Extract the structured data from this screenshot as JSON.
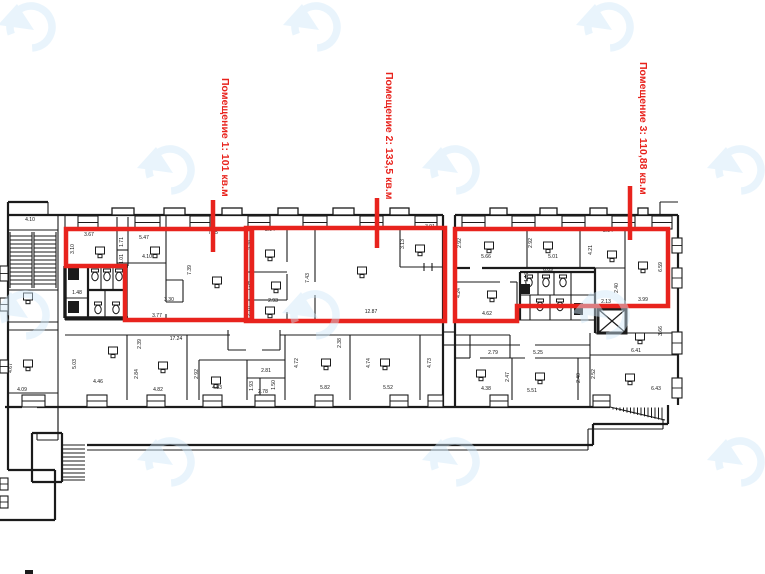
{
  "colors": {
    "annotation_red": "#e8231d",
    "wall_black": "#1b1b1b",
    "watermark_blue": "#cfe8f9"
  },
  "annotations": {
    "premises": [
      {
        "label": "Помещение 1: 101 кв.м",
        "label_x": 222,
        "label_y": 78,
        "leader": [
          213,
          200,
          213,
          252
        ],
        "outline": [
          [
            66,
            229
          ],
          [
            252,
            229
          ],
          [
            252,
            320
          ],
          [
            125,
            320
          ],
          [
            125,
            266
          ],
          [
            66,
            266
          ]
        ]
      },
      {
        "label": "Помещение 2: 133,5 кв.м",
        "label_x": 386,
        "label_y": 72,
        "leader": [
          377,
          198,
          377,
          248
        ],
        "outline": [
          [
            246,
            228
          ],
          [
            445,
            228
          ],
          [
            445,
            321
          ],
          [
            246,
            321
          ]
        ]
      },
      {
        "label": "Помещение 3: 110,88 кв.м",
        "label_x": 640,
        "label_y": 62,
        "leader": [
          630,
          186,
          630,
          240
        ],
        "outline": [
          [
            455,
            229
          ],
          [
            668,
            229
          ],
          [
            668,
            306
          ],
          [
            517,
            306
          ],
          [
            517,
            321
          ],
          [
            455,
            321
          ]
        ]
      }
    ]
  },
  "plan": {
    "dimensions": [
      {
        "v": "4.10",
        "x": 30,
        "y": 221,
        "r": 0
      },
      {
        "v": "4.67",
        "x": 12,
        "y": 368,
        "r": -90
      },
      {
        "v": "4.09",
        "x": 22,
        "y": 391,
        "r": 0
      },
      {
        "v": "3.67",
        "x": 89,
        "y": 236,
        "r": 0
      },
      {
        "v": "3.10",
        "x": 74,
        "y": 249,
        "r": -90
      },
      {
        "v": "1.71",
        "x": 123,
        "y": 242,
        "r": -90
      },
      {
        "v": "1.01",
        "x": 123,
        "y": 259,
        "r": -90
      },
      {
        "v": "5.47",
        "x": 144,
        "y": 239,
        "r": 0
      },
      {
        "v": "4.10",
        "x": 147,
        "y": 258,
        "r": 0
      },
      {
        "v": "7.45",
        "x": 213,
        "y": 234,
        "r": 0
      },
      {
        "v": "7.39",
        "x": 191,
        "y": 270,
        "r": -90
      },
      {
        "v": "3.30",
        "x": 169,
        "y": 301,
        "r": 0
      },
      {
        "v": "3.77",
        "x": 157,
        "y": 317,
        "r": 0
      },
      {
        "v": "1.48",
        "x": 77,
        "y": 294,
        "r": 0
      },
      {
        "v": "17.24",
        "x": 176,
        "y": 340,
        "r": 0
      },
      {
        "v": "2.94",
        "x": 270,
        "y": 231,
        "r": 0
      },
      {
        "v": "3.78",
        "x": 252,
        "y": 245,
        "r": -90
      },
      {
        "v": "1.34",
        "x": 250,
        "y": 286,
        "r": -90
      },
      {
        "v": "2.93",
        "x": 273,
        "y": 302,
        "r": 0
      },
      {
        "v": "2.18",
        "x": 250,
        "y": 311,
        "r": -90
      },
      {
        "v": "7.43",
        "x": 309,
        "y": 278,
        "r": -90
      },
      {
        "v": "12.87",
        "x": 371,
        "y": 313,
        "r": 0
      },
      {
        "v": "3.91",
        "x": 430,
        "y": 228,
        "r": 0
      },
      {
        "v": "3.13",
        "x": 404,
        "y": 244,
        "r": -90
      },
      {
        "v": "2.39",
        "x": 141,
        "y": 344,
        "r": -90
      },
      {
        "v": "2.38",
        "x": 341,
        "y": 343,
        "r": -90
      },
      {
        "v": "5.03",
        "x": 76,
        "y": 364,
        "r": -90
      },
      {
        "v": "4.46",
        "x": 98,
        "y": 383,
        "r": 0
      },
      {
        "v": "2.84",
        "x": 138,
        "y": 374,
        "r": -90
      },
      {
        "v": "4.82",
        "x": 158,
        "y": 391,
        "r": 0
      },
      {
        "v": "2.92",
        "x": 198,
        "y": 374,
        "r": -90
      },
      {
        "v": "4.83",
        "x": 217,
        "y": 389,
        "r": 0
      },
      {
        "v": "2.81",
        "x": 266,
        "y": 372,
        "r": 0
      },
      {
        "v": "1.93",
        "x": 253,
        "y": 386,
        "r": -90
      },
      {
        "v": "2.78",
        "x": 263,
        "y": 393,
        "r": 0
      },
      {
        "v": "1.50",
        "x": 275,
        "y": 385,
        "r": -90
      },
      {
        "v": "4.72",
        "x": 298,
        "y": 363,
        "r": -90
      },
      {
        "v": "5.82",
        "x": 325,
        "y": 389,
        "r": 0
      },
      {
        "v": "4.74",
        "x": 370,
        "y": 363,
        "r": -90
      },
      {
        "v": "5.52",
        "x": 388,
        "y": 389,
        "r": 0
      },
      {
        "v": "4.73",
        "x": 431,
        "y": 363,
        "r": -90
      },
      {
        "v": "2.92",
        "x": 461,
        "y": 243,
        "r": -90
      },
      {
        "v": "5.66",
        "x": 486,
        "y": 258,
        "r": 0
      },
      {
        "v": "2.92",
        "x": 532,
        "y": 243,
        "r": -90
      },
      {
        "v": "5.01",
        "x": 553,
        "y": 258,
        "r": 0
      },
      {
        "v": "2.54",
        "x": 608,
        "y": 232,
        "r": 0
      },
      {
        "v": "4.21",
        "x": 592,
        "y": 250,
        "r": -90
      },
      {
        "v": "6.09",
        "x": 548,
        "y": 271,
        "r": 0
      },
      {
        "v": "1.17",
        "x": 528,
        "y": 277,
        "r": -90
      },
      {
        "v": "4.24",
        "x": 460,
        "y": 293,
        "r": -90
      },
      {
        "v": "4.62",
        "x": 487,
        "y": 315,
        "r": 0
      },
      {
        "v": "6.59",
        "x": 662,
        "y": 267,
        "r": -90
      },
      {
        "v": "2.40",
        "x": 618,
        "y": 288,
        "r": -90
      },
      {
        "v": "2.13",
        "x": 606,
        "y": 303,
        "r": 0
      },
      {
        "v": "3.99",
        "x": 643,
        "y": 301,
        "r": 0
      },
      {
        "v": "3.66",
        "x": 662,
        "y": 331,
        "r": -90
      },
      {
        "v": "6.41",
        "x": 636,
        "y": 352,
        "r": 0
      },
      {
        "v": "2.79",
        "x": 493,
        "y": 354,
        "r": 0
      },
      {
        "v": "5.25",
        "x": 538,
        "y": 354,
        "r": 0
      },
      {
        "v": "4.38",
        "x": 486,
        "y": 390,
        "r": 0
      },
      {
        "v": "2.47",
        "x": 509,
        "y": 377,
        "r": -90
      },
      {
        "v": "5.51",
        "x": 532,
        "y": 392,
        "r": 0
      },
      {
        "v": "2.40",
        "x": 580,
        "y": 378,
        "r": -90
      },
      {
        "v": "2.52",
        "x": 595,
        "y": 374,
        "r": -90
      },
      {
        "v": "6.43",
        "x": 656,
        "y": 390,
        "r": 0
      }
    ],
    "fixtures": {
      "desks": [
        [
          28,
          298
        ],
        [
          28,
          365
        ],
        [
          100,
          252
        ],
        [
          155,
          252
        ],
        [
          217,
          282
        ],
        [
          270,
          255
        ],
        [
          276,
          287
        ],
        [
          270,
          312
        ],
        [
          362,
          272
        ],
        [
          420,
          250
        ],
        [
          113,
          352
        ],
        [
          163,
          367
        ],
        [
          216,
          382
        ],
        [
          326,
          364
        ],
        [
          385,
          364
        ],
        [
          489,
          247
        ],
        [
          548,
          247
        ],
        [
          612,
          256
        ],
        [
          643,
          267
        ],
        [
          492,
          296
        ],
        [
          640,
          338
        ],
        [
          481,
          375
        ],
        [
          540,
          378
        ],
        [
          630,
          379
        ]
      ],
      "toilets": [
        [
          95,
          270
        ],
        [
          107,
          270
        ],
        [
          119,
          270
        ],
        [
          98,
          303
        ],
        [
          116,
          303
        ],
        [
          529,
          276
        ],
        [
          546,
          276
        ],
        [
          563,
          276
        ],
        [
          540,
          300
        ],
        [
          560,
          300
        ]
      ],
      "black_boxes": [
        [
          68,
          268,
          11,
          12
        ],
        [
          68,
          301,
          11,
          12
        ],
        [
          521,
          284,
          9,
          10
        ],
        [
          574,
          303,
          9,
          12
        ],
        [
          25,
          570,
          8,
          4
        ]
      ],
      "elevator": {
        "x": 598,
        "y": 309,
        "w": 28,
        "h": 24
      }
    }
  },
  "watermark": {
    "positions": [
      [
        31,
        27
      ],
      [
        316,
        27
      ],
      [
        609,
        27
      ],
      [
        170,
        170
      ],
      [
        455,
        170
      ],
      [
        740,
        170
      ],
      [
        25,
        315
      ],
      [
        315,
        315
      ],
      [
        605,
        315
      ],
      [
        170,
        462
      ],
      [
        455,
        462
      ],
      [
        740,
        462
      ]
    ]
  }
}
